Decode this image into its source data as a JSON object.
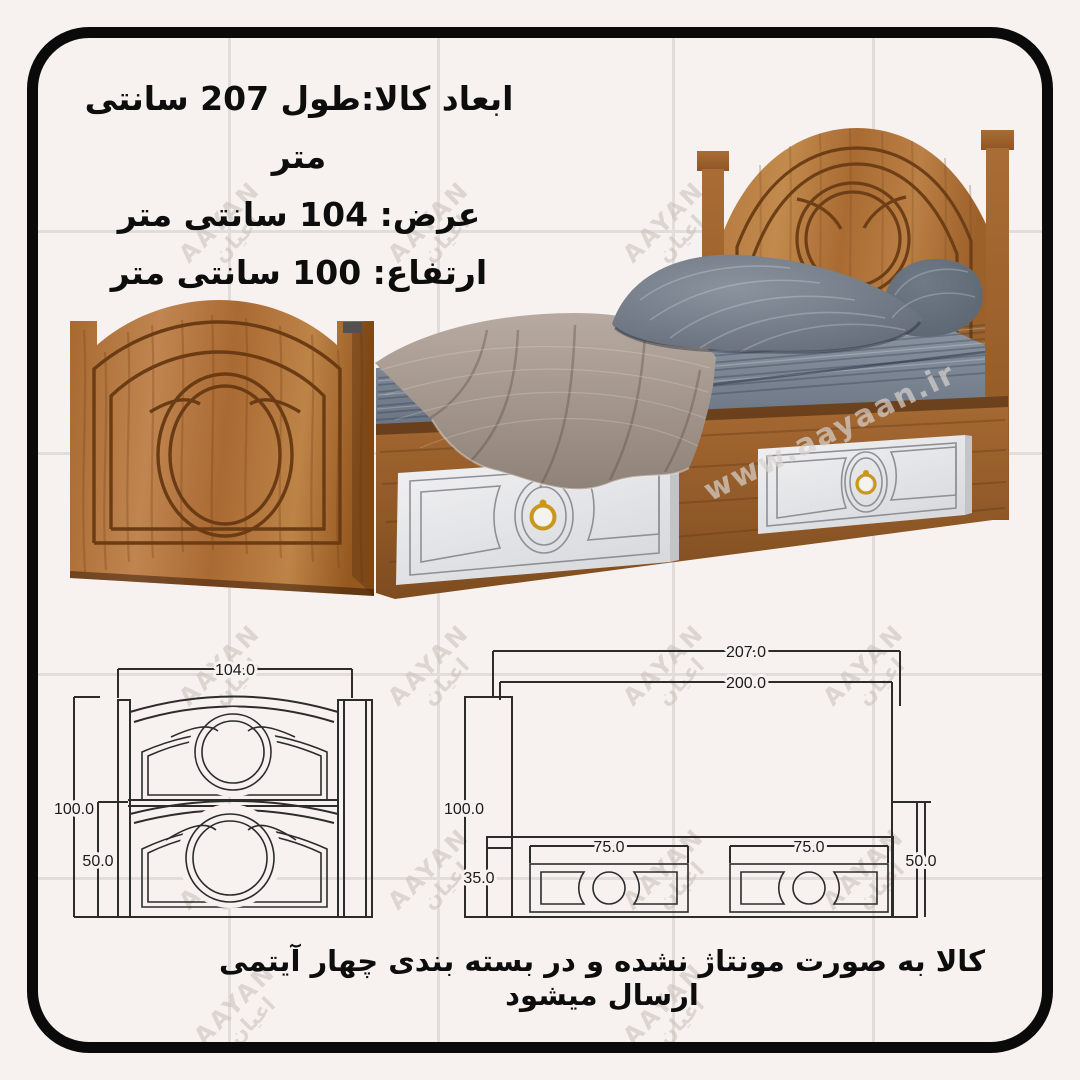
{
  "spec": {
    "line1": "ابعاد کالا:طول 207 سانتی متر",
    "line2": "عرض: 104 سانتی متر",
    "line3": "ارتفاع: 100 سانتی متر"
  },
  "note": "کالا به صورت مونتاژ نشده و در بسته بندی چهار آیتمی ارسال میشود",
  "watermark": {
    "latin": "AAYAN",
    "persian": "اعیان",
    "site": "www.aayaan.ir"
  },
  "drawings": {
    "front": {
      "width": "104.0",
      "height": "100.0",
      "footboard_height": "50.0"
    },
    "side": {
      "length_total": "207.0",
      "length_inner": "200.0",
      "height": "100.0",
      "base_height": "35.0",
      "drawer_width_1": "75.0",
      "drawer_width_2": "75.0",
      "footboard_height": "50.0"
    }
  },
  "colors": {
    "background": "#f7f2ef",
    "frame": "#0a0a0a",
    "wood": "#b5793e",
    "wood_dark": "#8a5223",
    "drawer_front": "#ececef",
    "handle_gold": "#c9971c",
    "pillow": "#6b7480",
    "sheet": "#7b8592",
    "blanket": "#a89b94",
    "line": "#2c2c2c"
  }
}
